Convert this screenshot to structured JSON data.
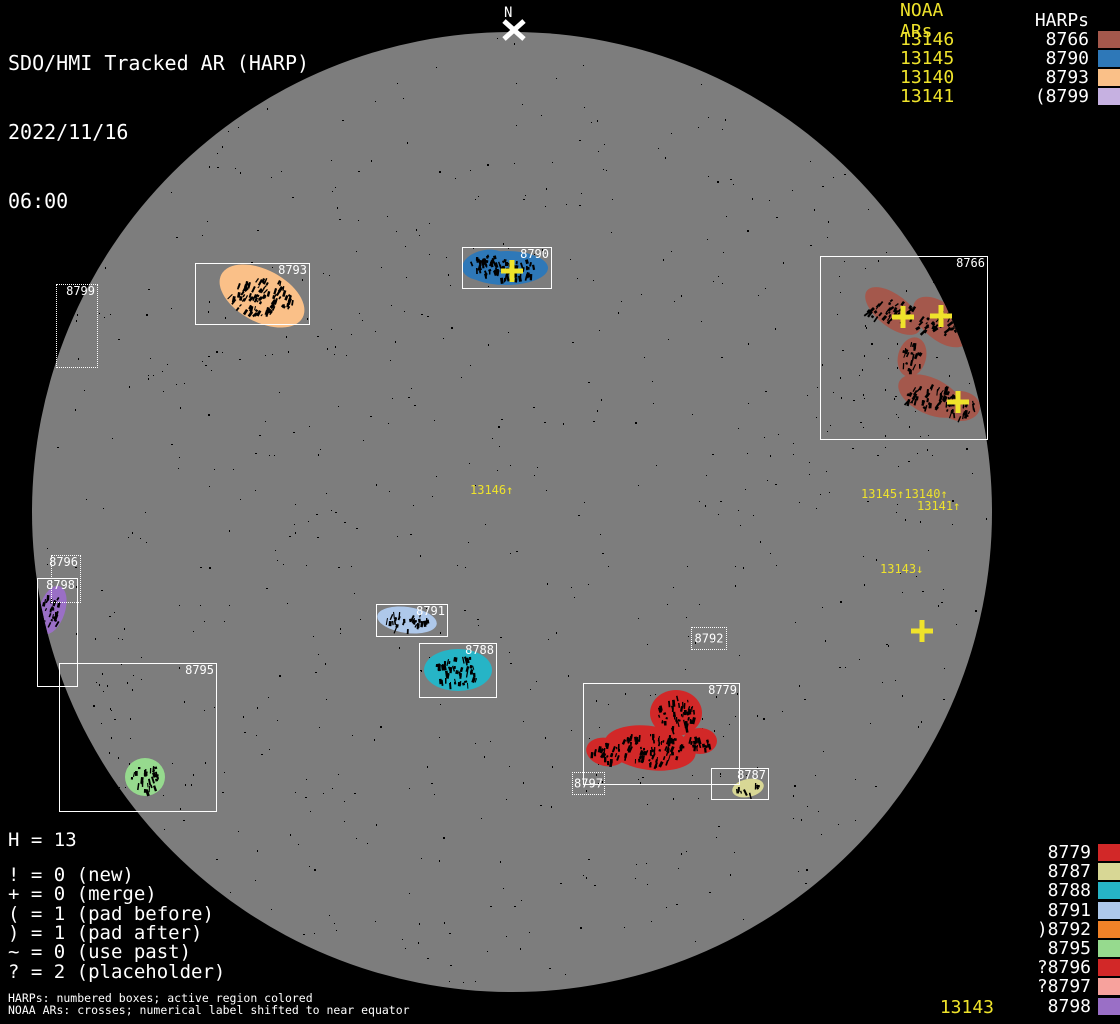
{
  "colors": {
    "yellow": "#efe32b",
    "white": "#ffffff",
    "disk": "#7d7d7d",
    "background": "#000000"
  },
  "header": {
    "title": "SDO/HMI Tracked AR (HARP)",
    "date": "2022/11/16",
    "time": "06:00"
  },
  "north_marker": {
    "label": "N"
  },
  "legend_top_right": {
    "noaa_header": "NOAA ARs",
    "harp_header": "HARPs",
    "rows": [
      {
        "noaa": "13146",
        "harp": "8766",
        "color": "#a4584c"
      },
      {
        "noaa": "13145",
        "harp": "8790",
        "color": "#2e78b8"
      },
      {
        "noaa": "13140",
        "harp": "8793",
        "color": "#fac088"
      },
      {
        "noaa": "13141",
        "harp": "(8799",
        "color": "#c6b1e1"
      }
    ]
  },
  "harp_list_bottom_right": {
    "rows": [
      {
        "label": "8779",
        "color": "#d22828"
      },
      {
        "label": "8787",
        "color": "#d8d795"
      },
      {
        "label": "8788",
        "color": "#26b4c6"
      },
      {
        "label": "8791",
        "color": "#aec8ea"
      },
      {
        "label": ")8792",
        "color": "#f08228"
      },
      {
        "label": "8795",
        "color": "#96da8e"
      },
      {
        "label": "?8796",
        "color": "#d22828"
      },
      {
        "label": "?8797",
        "color": "#f7a29d"
      },
      {
        "label": "8798",
        "color": "#9a6fc6"
      }
    ],
    "noaa_footer": "13143"
  },
  "stats": {
    "harp_count": "H = 13",
    "lines": [
      "! = 0 (new)",
      "+ = 0 (merge)",
      "( = 1 (pad before)",
      ") = 1 (pad after)",
      "~ = 0 (use past)",
      "? = 2 (placeholder)"
    ]
  },
  "captions": {
    "line1": "HARPs: numbered boxes; active region colored",
    "line2": "NOAA ARs: crosses; numerical label shifted to near equator"
  },
  "chart_data": {
    "type": "scatter",
    "title": "SDO/HMI Tracked AR (HARP) 2022/11/16 06:00",
    "disk": {
      "cx": 512,
      "cy": 512,
      "r": 480,
      "color": "#7d7d7d"
    },
    "boxes": [
      {
        "harp": "8793",
        "x": 195,
        "y": 263,
        "w": 115,
        "h": 62,
        "style": "solid",
        "label": "tr"
      },
      {
        "harp": "8790",
        "x": 462,
        "y": 247,
        "w": 90,
        "h": 42,
        "style": "solid",
        "label": "tr"
      },
      {
        "harp": "8766",
        "x": 820,
        "y": 256,
        "w": 168,
        "h": 184,
        "style": "solid",
        "label": "tr"
      },
      {
        "harp": "8799",
        "x": 56,
        "y": 284,
        "w": 42,
        "h": 84,
        "style": "dotted",
        "label": "tr"
      },
      {
        "harp": "8796",
        "x": 51,
        "y": 555,
        "w": 30,
        "h": 48,
        "style": "dotted",
        "label": "tr"
      },
      {
        "harp": "8798",
        "x": 37,
        "y": 578,
        "w": 41,
        "h": 109,
        "style": "solid",
        "label": "tr"
      },
      {
        "harp": "8795",
        "x": 59,
        "y": 663,
        "w": 158,
        "h": 149,
        "style": "solid",
        "label": "tr"
      },
      {
        "harp": "8791",
        "x": 376,
        "y": 604,
        "w": 72,
        "h": 33,
        "style": "solid",
        "label": "tr"
      },
      {
        "harp": "8788",
        "x": 419,
        "y": 643,
        "w": 78,
        "h": 55,
        "style": "solid",
        "label": "tr"
      },
      {
        "harp": "8792",
        "x": 691,
        "y": 627,
        "w": 36,
        "h": 23,
        "style": "dotted",
        "label": "c"
      },
      {
        "harp": "8779",
        "x": 583,
        "y": 683,
        "w": 157,
        "h": 102,
        "style": "solid",
        "label": "tr"
      },
      {
        "harp": "8797",
        "x": 572,
        "y": 772,
        "w": 33,
        "h": 23,
        "style": "dotted",
        "label": "c"
      },
      {
        "harp": "8787",
        "x": 711,
        "y": 768,
        "w": 58,
        "h": 32,
        "style": "solid",
        "label": "tr"
      }
    ],
    "regions": [
      {
        "harp": "8793",
        "color": "#fac088",
        "ellipses": [
          {
            "cx": 262,
            "cy": 296,
            "rx": 46,
            "ry": 26,
            "rot": 28
          }
        ]
      },
      {
        "harp": "8790",
        "color": "#2e78b8",
        "ellipses": [
          {
            "cx": 506,
            "cy": 268,
            "rx": 42,
            "ry": 17,
            "rot": 0
          },
          {
            "cx": 486,
            "cy": 265,
            "rx": 24,
            "ry": 15,
            "rot": -10
          }
        ]
      },
      {
        "harp": "8766",
        "color": "#a4584c",
        "ellipses": [
          {
            "cx": 893,
            "cy": 311,
            "rx": 33,
            "ry": 16,
            "rot": 38
          },
          {
            "cx": 941,
            "cy": 322,
            "rx": 33,
            "ry": 18,
            "rot": 40
          },
          {
            "cx": 912,
            "cy": 357,
            "rx": 14,
            "ry": 20,
            "rot": 15
          },
          {
            "cx": 930,
            "cy": 396,
            "rx": 34,
            "ry": 18,
            "rot": 25
          },
          {
            "cx": 960,
            "cy": 406,
            "rx": 20,
            "ry": 15,
            "rot": 5
          }
        ]
      },
      {
        "harp": "8798",
        "color": "#9a6fc6",
        "ellipses": [
          {
            "cx": 52,
            "cy": 610,
            "rx": 13,
            "ry": 25,
            "rot": 18
          }
        ]
      },
      {
        "harp": "8795",
        "color": "#96da8e",
        "ellipses": [
          {
            "cx": 145,
            "cy": 777,
            "rx": 20,
            "ry": 19,
            "rot": 0
          }
        ]
      },
      {
        "harp": "8791",
        "color": "#aec8ea",
        "ellipses": [
          {
            "cx": 407,
            "cy": 620,
            "rx": 30,
            "ry": 13,
            "rot": 8
          }
        ]
      },
      {
        "harp": "8788",
        "color": "#26b4c6",
        "ellipses": [
          {
            "cx": 458,
            "cy": 670,
            "rx": 34,
            "ry": 21,
            "rot": 0
          }
        ]
      },
      {
        "harp": "8779",
        "color": "#d22828",
        "ellipses": [
          {
            "cx": 676,
            "cy": 713,
            "rx": 26,
            "ry": 23,
            "rot": 0
          },
          {
            "cx": 650,
            "cy": 748,
            "rx": 46,
            "ry": 22,
            "rot": 8
          },
          {
            "cx": 606,
            "cy": 752,
            "rx": 20,
            "ry": 14,
            "rot": 12
          },
          {
            "cx": 700,
            "cy": 741,
            "rx": 17,
            "ry": 13,
            "rot": 0
          }
        ]
      },
      {
        "harp": "8787",
        "color": "#d8d795",
        "ellipses": [
          {
            "cx": 748,
            "cy": 788,
            "rx": 16,
            "ry": 9,
            "rot": -12
          }
        ]
      }
    ],
    "crosses": [
      {
        "x": 512,
        "y": 271
      },
      {
        "x": 903,
        "y": 317
      },
      {
        "x": 941,
        "y": 316
      },
      {
        "x": 958,
        "y": 402
      },
      {
        "x": 922,
        "y": 631
      }
    ],
    "noaa_labels": [
      {
        "text": "13146↑",
        "x": 470,
        "y": 484
      },
      {
        "text": "13145↑13140↑",
        "x": 861,
        "y": 488
      },
      {
        "text": "13141↑",
        "x": 917,
        "y": 500
      },
      {
        "text": "13143↓",
        "x": 880,
        "y": 563
      }
    ],
    "north_x": {
      "x": 514,
      "y": 30
    }
  }
}
